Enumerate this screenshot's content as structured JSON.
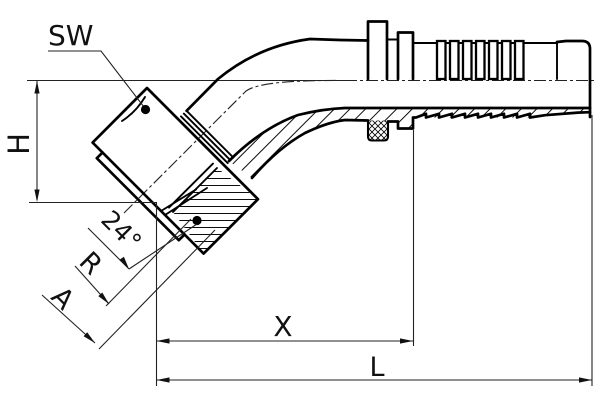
{
  "drawing": {
    "labels": {
      "wrench_size": "SW",
      "height": "H",
      "cone_angle": "24°",
      "thread": "R",
      "diameter": "A",
      "cutoff_length": "X",
      "overall_length": "L"
    },
    "colors": {
      "background": "#ffffff",
      "object_line": "#000000",
      "dimension_line": "#222222"
    }
  }
}
